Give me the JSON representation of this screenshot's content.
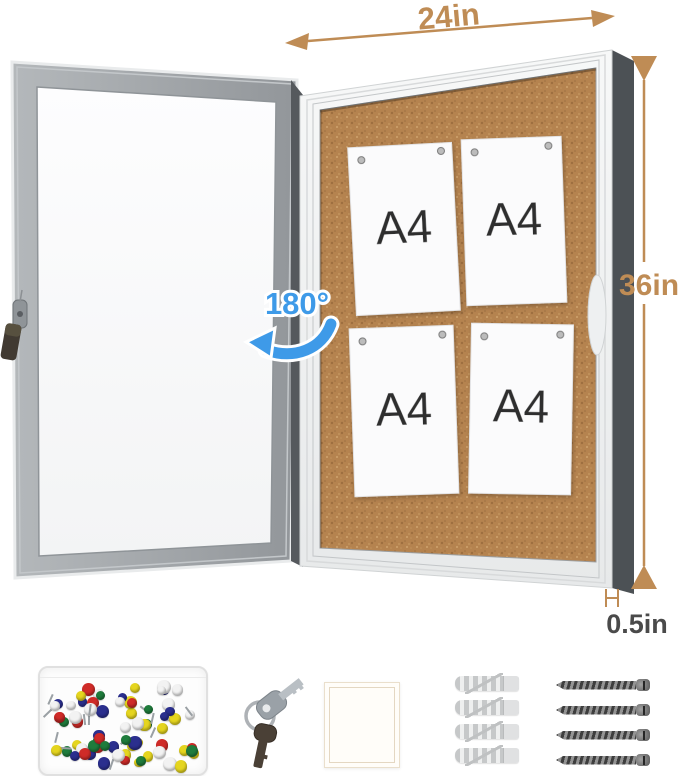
{
  "annotations": {
    "width": "24in",
    "height": "36in",
    "thickness": "0.5in",
    "door_rotation": "180°",
    "dimension_color": "#bf8c55",
    "thickness_text_color": "#4a4a4a",
    "rotation_color": "#3e9ae8"
  },
  "board": {
    "papers": [
      {
        "label": "A4"
      },
      {
        "label": "A4"
      },
      {
        "label": "A4"
      },
      {
        "label": "A4"
      }
    ],
    "cork_color": "#b5834f",
    "frame_color": "#f2f3f4",
    "side_panel_color": "#4c5155",
    "door_frame_color": "#a2a6aa"
  },
  "accessories": {
    "pushpin_box": {
      "name": "assorted-push-pins-box",
      "pin_count": 72,
      "pin_colors": [
        "#cf2b28",
        "#2b2f8e",
        "#1f7c3c",
        "#e5d51f",
        "#f2f2f2"
      ]
    },
    "keys": {
      "name": "lock-keys"
    },
    "white_pad": {
      "name": "white-square-pad"
    },
    "anchors": {
      "name": "wall-anchors",
      "count": 4
    },
    "screws": {
      "name": "mounting-screws",
      "count": 4
    }
  }
}
